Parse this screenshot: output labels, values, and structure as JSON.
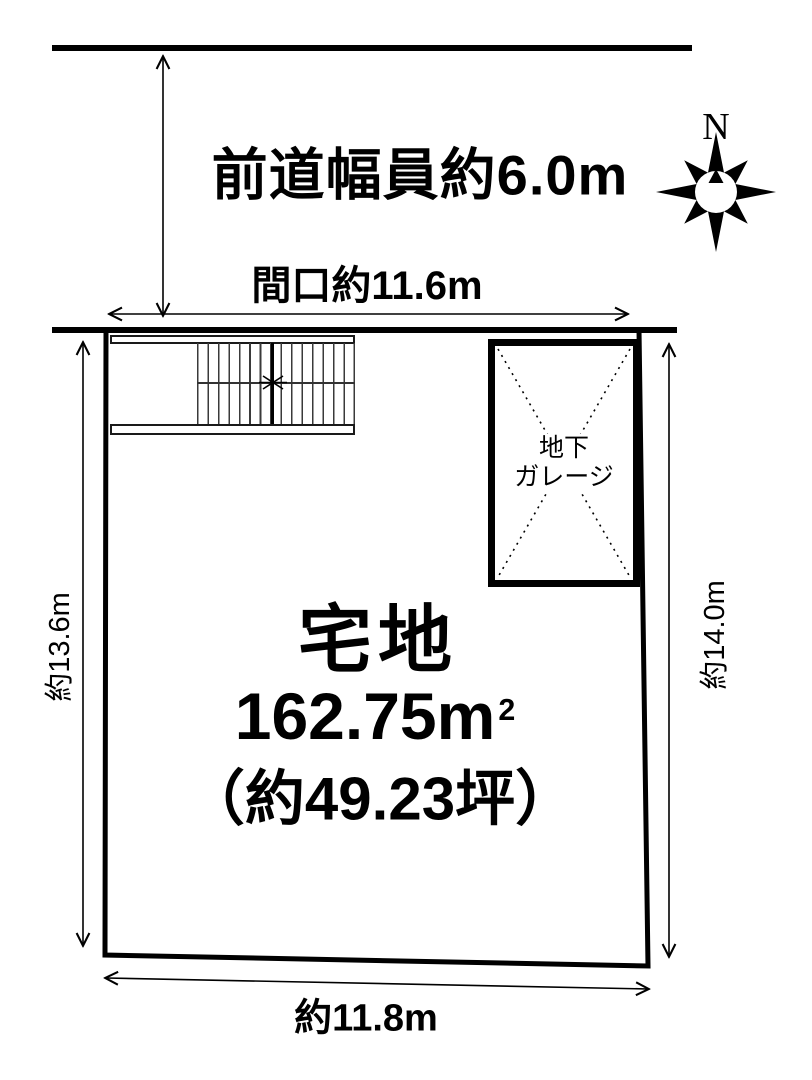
{
  "diagram": {
    "road": {
      "width_label": "前道幅員約6.0m"
    },
    "frontage": {
      "label": "間口約11.6m"
    },
    "compass": {
      "north": "N"
    },
    "plot": {
      "type_label": "宅地",
      "area_label": "162.75m",
      "area_sup": "2",
      "tsubo_label": "（約49.23坪）"
    },
    "garage": {
      "line1": "地下",
      "line2": "ガレージ"
    },
    "dimensions": {
      "left": "約13.6m",
      "right": "約14.0m",
      "bottom": "約11.8m"
    },
    "colors": {
      "ink": "#000000",
      "paper": "#ffffff"
    }
  }
}
